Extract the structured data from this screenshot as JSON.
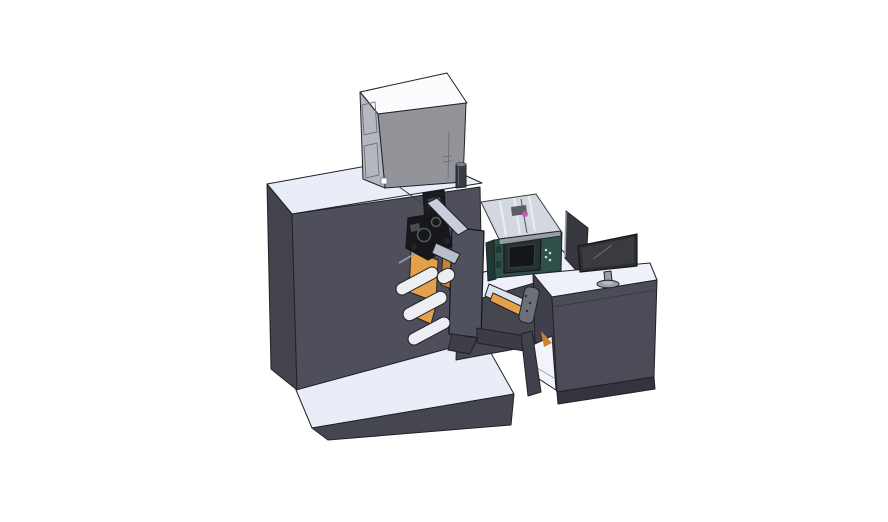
{
  "meta": {
    "description": "Isometric 3D CAD render of a digital label press / rewinder machine with operator desk and monitor on a white background",
    "background": "#ffffff"
  },
  "colors": {
    "machineTop": "#e9edf8",
    "machineLeft": "#42434d",
    "machineFront": "#4e4f5a",
    "platformTop": "#e9edf8",
    "platformFront": "#454650",
    "wingTop": "#eef1f9",
    "wingFront": "#45464f",
    "boxTop": "#fbfcfe",
    "boxLeft": "#b4b7bd",
    "boxFront": "#93949a",
    "boxWindow": "#59606e",
    "cylinder": "#3a3b42",
    "cylinderTop": "#7d828c",
    "panel": "#50515e",
    "panelFoot": "#3d3e48",
    "mechBlack": "#17181c",
    "mechColumn": "#1b1c20",
    "mechGray": "#4a4c52",
    "trayLight": "#c9cedb",
    "trayLight2": "#b9bfc9",
    "orange": "#e5a04b",
    "orangeDark": "#c8842f",
    "roller": "#eceef4",
    "greenBody": "#2e5048",
    "greenDark": "#1f3a33",
    "screenPanel": "#243230",
    "screenInner": "#14171a",
    "buttonDot": "#cfd6d2",
    "coverGlass": "#ccd2dc",
    "coverEdge": "#aeb4c0",
    "inkCarriage": "#595e67",
    "magenta": "#c05ab0",
    "beam": "#3b3c45",
    "ramp": "#dde1ea",
    "bracket": "#6c6f78",
    "deskTop": "#eef1f9",
    "deskFront": "#4b4c57",
    "deskSide": "#3f404b",
    "deskLeg": "#40414c",
    "deskPlinth": "#33343d",
    "cavity": "#f2f4fa",
    "backPanel": "#37383f",
    "monitorBezel": "#2c2d32",
    "monitorScreen": "#3a3b41",
    "stand": "#99a0ab",
    "standInner": "#b6bcc6",
    "whiteDetail": "#ffffff"
  },
  "scene": {
    "parts": [
      {
        "name": "main-cabinet",
        "desc": "large dark machine cabinet"
      },
      {
        "name": "base-platform",
        "desc": "light floor platform slab"
      },
      {
        "name": "unwinder-box",
        "desc": "gray box with two windows on machine top"
      },
      {
        "name": "exhaust-cylinder",
        "desc": "small dark cylinder beside box"
      },
      {
        "name": "print-mechanism",
        "desc": "black print-head mechanism with rollers"
      },
      {
        "name": "web-rollers",
        "desc": "light idler rollers"
      },
      {
        "name": "orange-belts",
        "desc": "orange belt plates"
      },
      {
        "name": "rewinder-panel",
        "desc": "vertical dark rewinder plate"
      },
      {
        "name": "inkjet-unit",
        "desc": "teal inkjet printer with translucent cover and display"
      },
      {
        "name": "transfer-beam",
        "desc": "beam with ramp and bracket linking machine to desk"
      },
      {
        "name": "operator-desk",
        "desc": "dark desk cabinet with white top and side shelf"
      },
      {
        "name": "monitor",
        "desc": "flat screen monitor on oval stand"
      },
      {
        "name": "back-panel",
        "desc": "angled dark panel behind monitor"
      }
    ]
  }
}
